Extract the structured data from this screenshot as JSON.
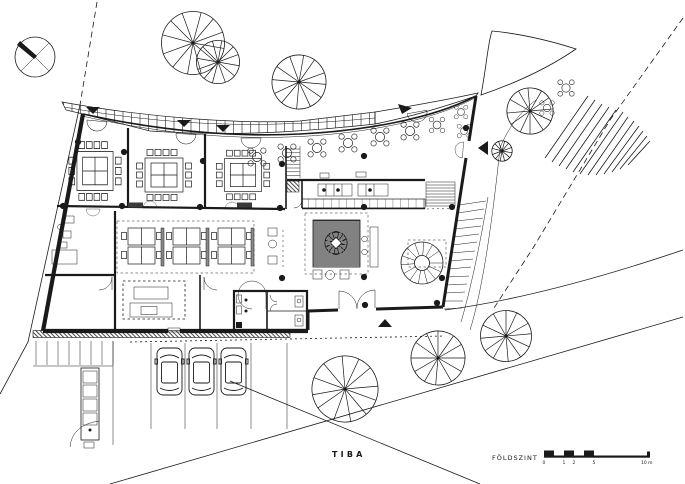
{
  "canvas": {
    "width": 685,
    "height": 484,
    "background": "#ffffff",
    "ink": "#1a1a1a"
  },
  "titleblock": {
    "firm": "TIBA",
    "floor_label": "FÖLDSZINT"
  },
  "scale_bar": {
    "unit": "m",
    "tick_labels": [
      "0",
      "1",
      "2",
      "5",
      "10 m"
    ]
  },
  "symbols": [
    {
      "name": "north-arrow-icon",
      "meaning": "north orientation"
    },
    {
      "name": "tree-icon",
      "meaning": "existing tree"
    },
    {
      "name": "entrance-arrow-icon",
      "meaning": "entrance direction marker"
    },
    {
      "name": "column-dot",
      "meaning": "structural column"
    },
    {
      "name": "spiral-stair-icon",
      "meaning": "spiral staircase"
    },
    {
      "name": "car-icon",
      "meaning": "parked car / parking space"
    },
    {
      "name": "planted-court",
      "meaning": "planted interior courtyard"
    },
    {
      "name": "conference-table",
      "meaning": "meeting room table with chairs"
    },
    {
      "name": "cafe-table",
      "meaning": "round cafe table with chairs"
    }
  ]
}
